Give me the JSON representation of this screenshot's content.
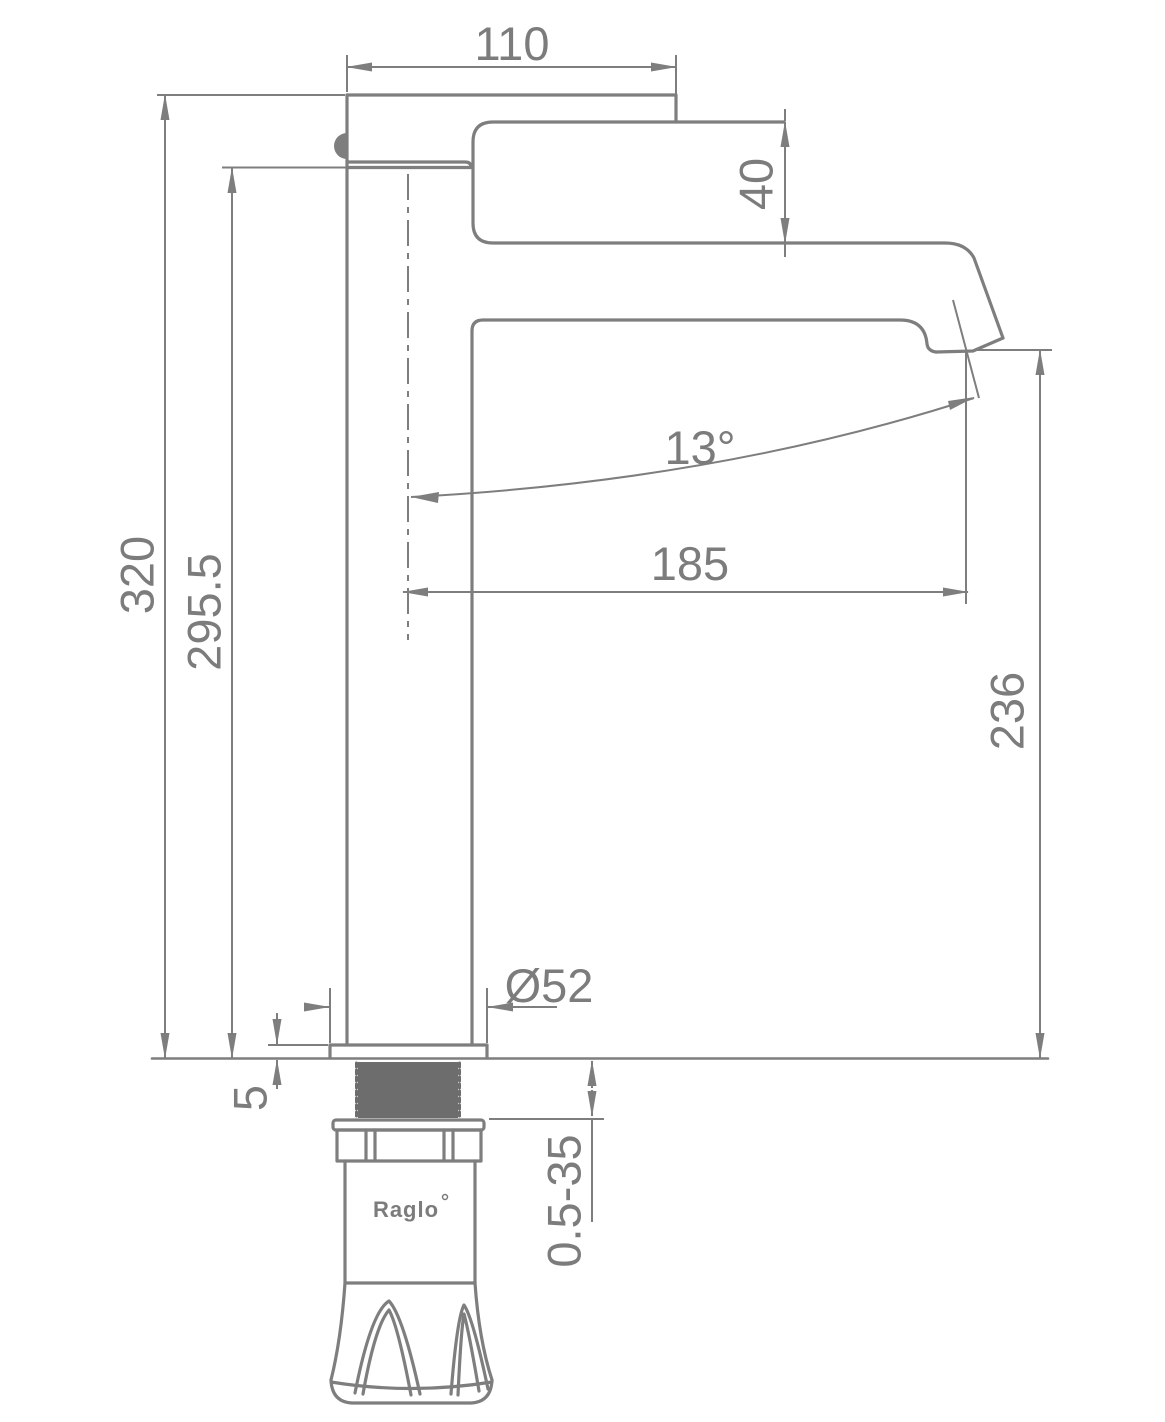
{
  "drawing": {
    "type": "faucet-dimension-drawing",
    "brand": {
      "name": "Raglo"
    },
    "dimensions": {
      "handle_top_width": "110",
      "handle_body_height": "40",
      "spout_angle": "13°",
      "spout_reach": "185",
      "total_height": "320",
      "body_height_above_deck": "295.5",
      "spout_outlet_height": "236",
      "base_diameter": "Ø52",
      "deck_plate_thickness": "5",
      "mounting_thickness_range": "0.5-35"
    },
    "colors": {
      "line": "#7e7e7e",
      "text": "#7c7c7c",
      "thread_fill": "#6d6d6d",
      "background": "#ffffff"
    }
  }
}
